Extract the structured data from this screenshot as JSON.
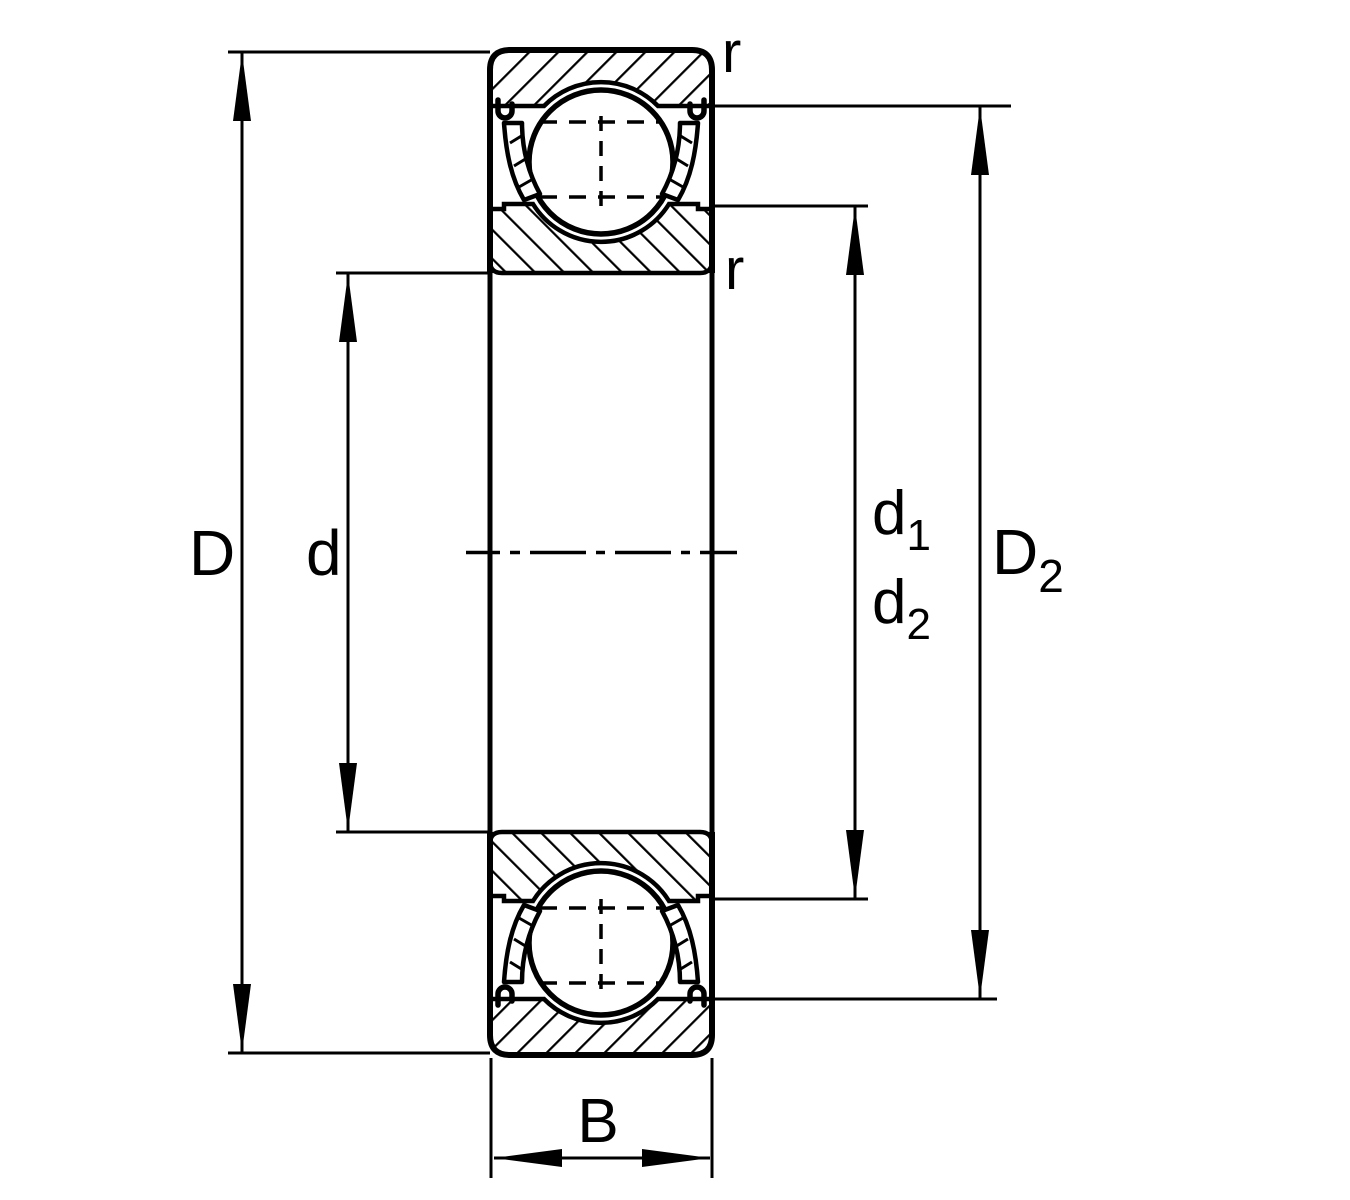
{
  "drawing": {
    "background_color": "#ffffff",
    "line_color": "#000000",
    "description": "Shielded deep groove ball bearing radial cross-section dimension drawing"
  },
  "dimensions": {
    "outer_diameter": "D",
    "bore_diameter": "d",
    "inner_shoulder_diameter": {
      "base": "d",
      "sub": "1"
    },
    "inner_recess_diameter": {
      "base": "d",
      "sub": "2"
    },
    "outer_recess_diameter": {
      "base": "D",
      "sub": "2"
    },
    "width": "B",
    "chamfer_radius_top": "r",
    "chamfer_radius_inner": "r"
  }
}
